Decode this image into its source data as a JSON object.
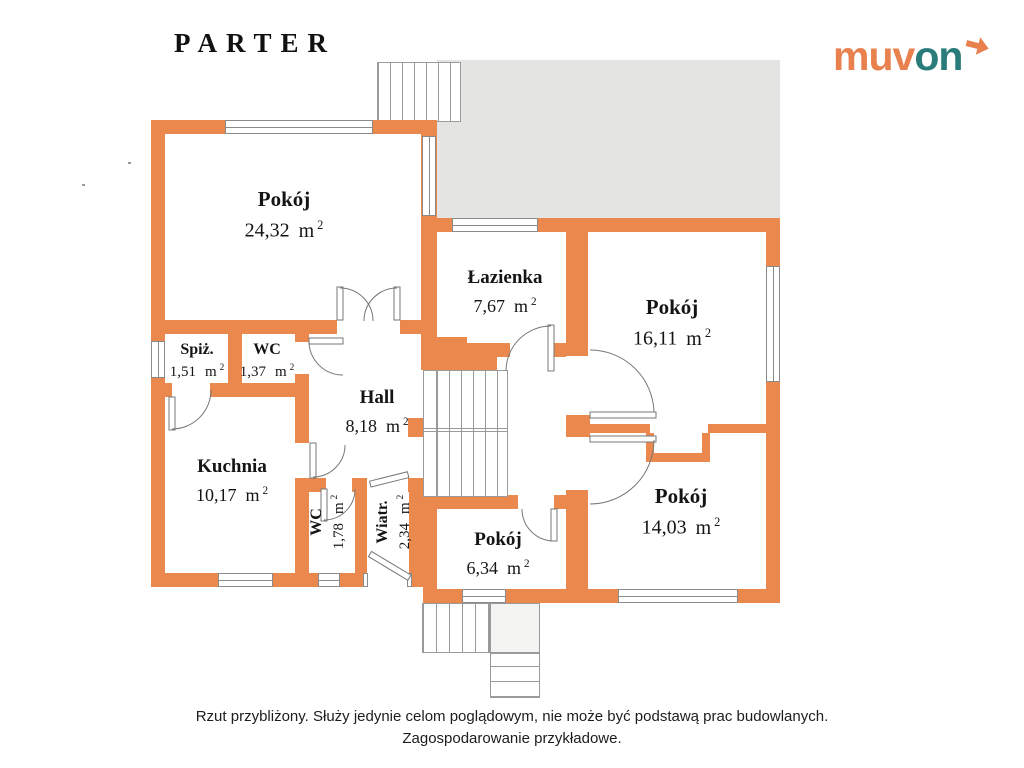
{
  "header": {
    "title": "PARTER"
  },
  "logo": {
    "part1": "muv",
    "part2": "on",
    "arrow_icon": "arrow-right-icon"
  },
  "rooms": [
    {
      "name": "Pokój",
      "area": "24,32",
      "unit": "m",
      "sup": "2"
    },
    {
      "name": "Łazienka",
      "area": "7,67",
      "unit": "m",
      "sup": "2"
    },
    {
      "name": "Pokój",
      "area": "16,11",
      "unit": "m",
      "sup": "2"
    },
    {
      "name": "Spiż.",
      "area": "1,51",
      "unit": "m",
      "sup": "2"
    },
    {
      "name": "WC",
      "area": "1,37",
      "unit": "m",
      "sup": "2"
    },
    {
      "name": "Hall",
      "area": "8,18",
      "unit": "m",
      "sup": "2"
    },
    {
      "name": "Kuchnia",
      "area": "10,17",
      "unit": "m",
      "sup": "2"
    },
    {
      "name": "WC",
      "area": "1,78",
      "unit": "m",
      "sup": "2"
    },
    {
      "name": "Wiatr.",
      "area": "2,34",
      "unit": "m",
      "sup": "2"
    },
    {
      "name": "Pokój",
      "area": "6,34",
      "unit": "m",
      "sup": "2"
    },
    {
      "name": "Pokój",
      "area": "14,03",
      "unit": "m",
      "sup": "2"
    }
  ],
  "footer": {
    "line1": "Rzut przybliżony. Służy jedynie celom poglądowym, nie może być podstawą prac budowlanych.",
    "line2": "Zagospodarowanie przykładowe."
  },
  "colors": {
    "wall": "#EA884D",
    "terrace": "#E4E4E3",
    "brand_orange": "#E8814E",
    "brand_teal": "#2A7C7A"
  }
}
